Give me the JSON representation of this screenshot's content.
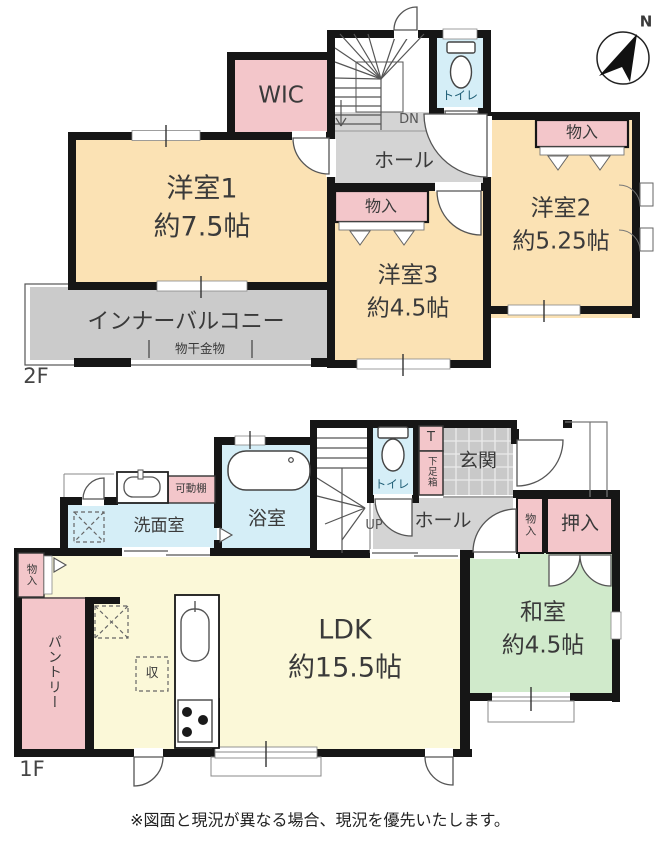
{
  "title": "間取り図",
  "compass": {
    "north": "N"
  },
  "floor2": {
    "floor_label": "2F",
    "wic": "WIC",
    "dn": "DN",
    "toilet": "トイレ",
    "hall": "ホール",
    "storage_right": "物入",
    "storage_mid": "物入",
    "room1": "洋室1",
    "room1_area": "約7.5帖",
    "room2": "洋室2",
    "room2_area": "約5.25帖",
    "room3": "洋室3",
    "room3_area": "約4.5帖",
    "balcony": "インナーバルコニー",
    "drying": "物干金物"
  },
  "floor1": {
    "floor_label": "1F",
    "toilet": "トイレ",
    "shoe_t": "T",
    "shoe_box": "下足箱",
    "entrance": "玄関",
    "up": "UP",
    "hall": "ホール",
    "storage_hall": "物入",
    "oshiire": "押入",
    "washitsu": "和室",
    "washitsu_area": "約4.5帖",
    "ldk": "LDK",
    "ldk_area": "約15.5帖",
    "pantry": "パントリー",
    "storage_pantry": "物入",
    "washroom": "洗面室",
    "bath": "浴室",
    "shelf": "可動棚",
    "storage_symbol": "収"
  },
  "notice": "※図面と現況が異なる場合、現況を優先いたします。",
  "colors": {
    "wall": "#161616",
    "western_room": "#fbe2b4",
    "storage_pink": "#f3c6ca",
    "hall_gray": "#d4d4d4",
    "balcony_gray": "#cbcbcb",
    "entrance_tile": "#c9c9c9",
    "wet_area_blue": "#d5eef7",
    "ldk_yellow": "#fbf8d8",
    "tatami_green": "#d0eacb",
    "toilet_text": "#1d5d75"
  }
}
